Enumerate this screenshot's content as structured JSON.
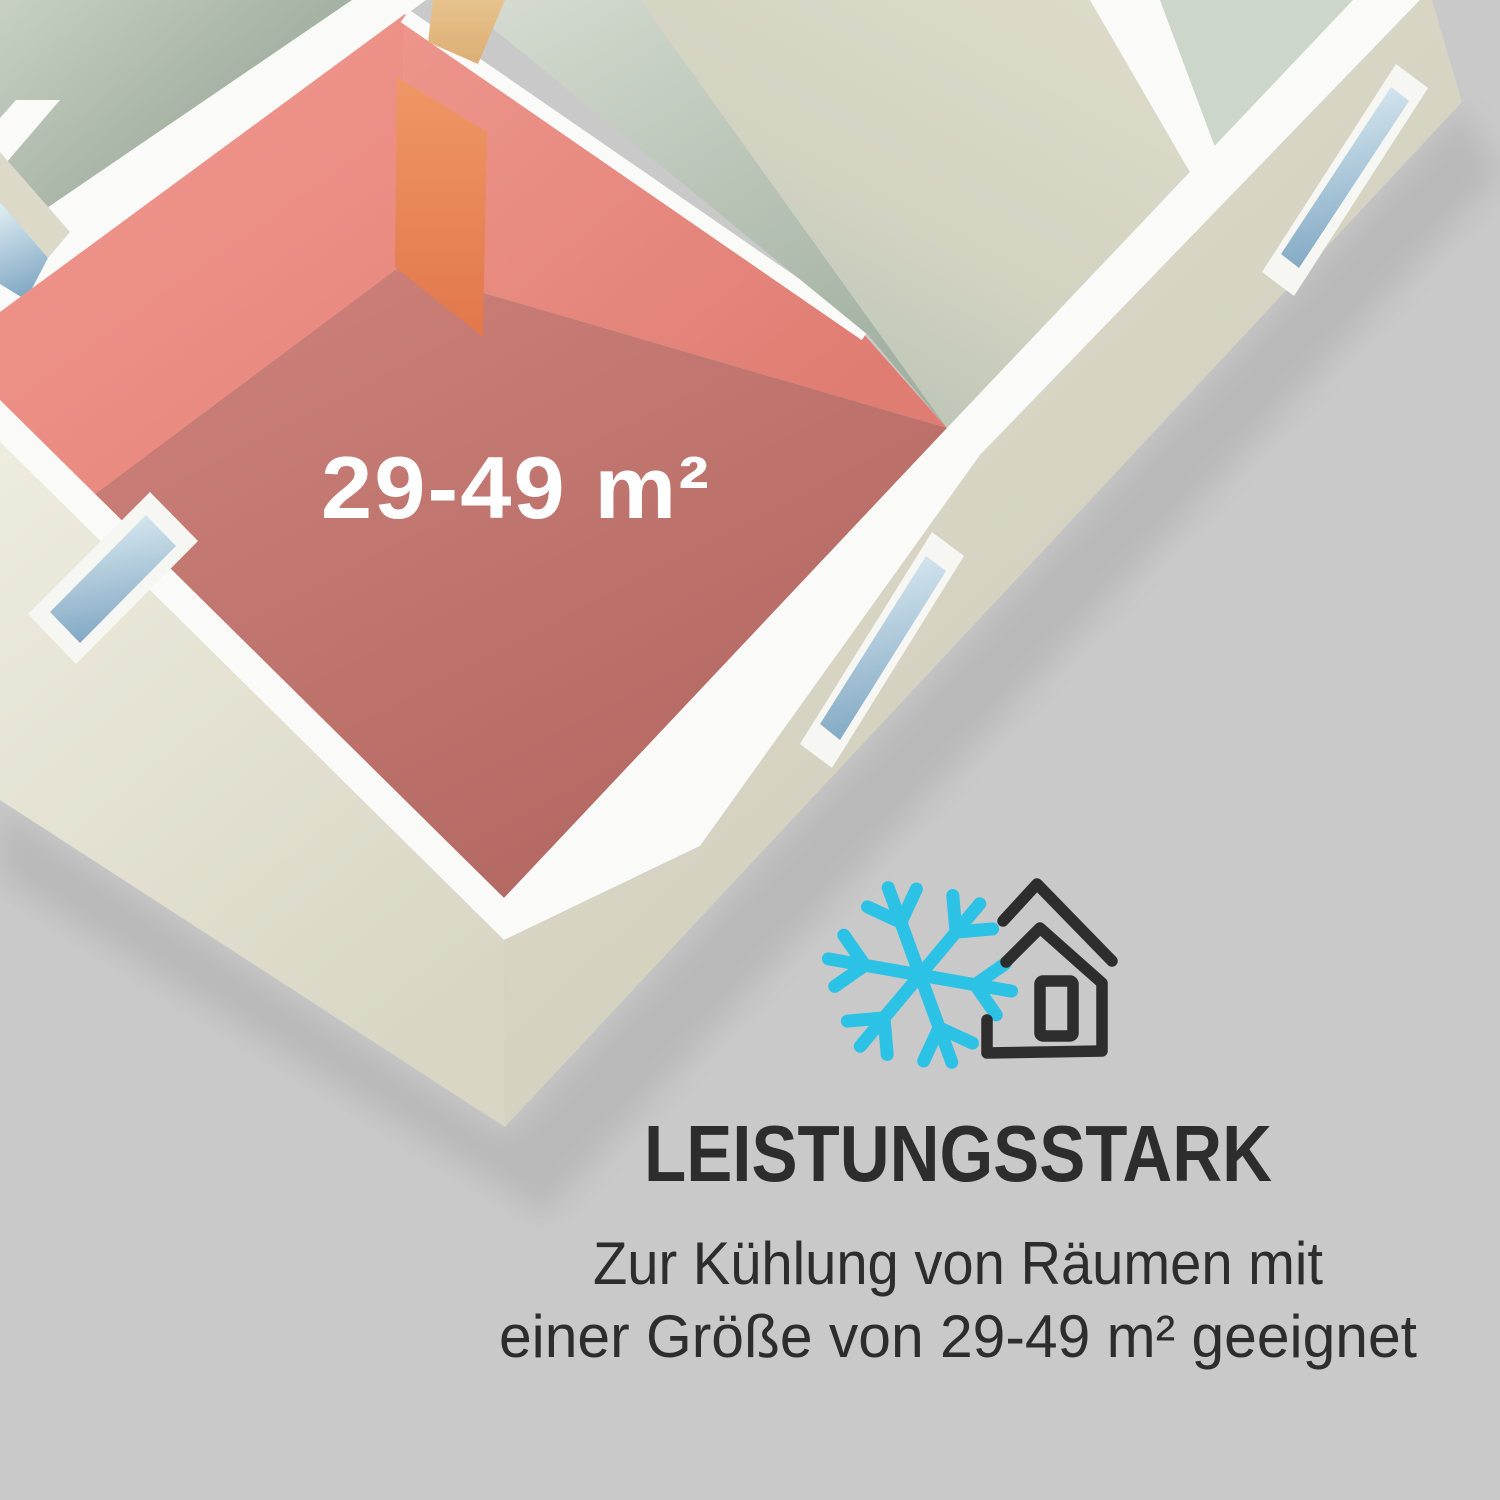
{
  "colors": {
    "bg": "#c9c9c9",
    "ink": "#2d2d2d",
    "accent": "#2cc2e5",
    "label": "#ffffff",
    "room_highlight": "#e8877e",
    "room_floor": "#bc6f68"
  },
  "floor_plan": {
    "description": "isometric cutaway floor plan with highlighted room",
    "room_label": "29-49 m²"
  },
  "feature": {
    "icons": [
      "snowflake-icon",
      "house-icon"
    ],
    "heading": "LEISTUNGSSTARK",
    "subtitle_lines": [
      "Zur Kühlung von Räumen mit",
      "einer Größe von 29-49 m² geeignet"
    ]
  }
}
